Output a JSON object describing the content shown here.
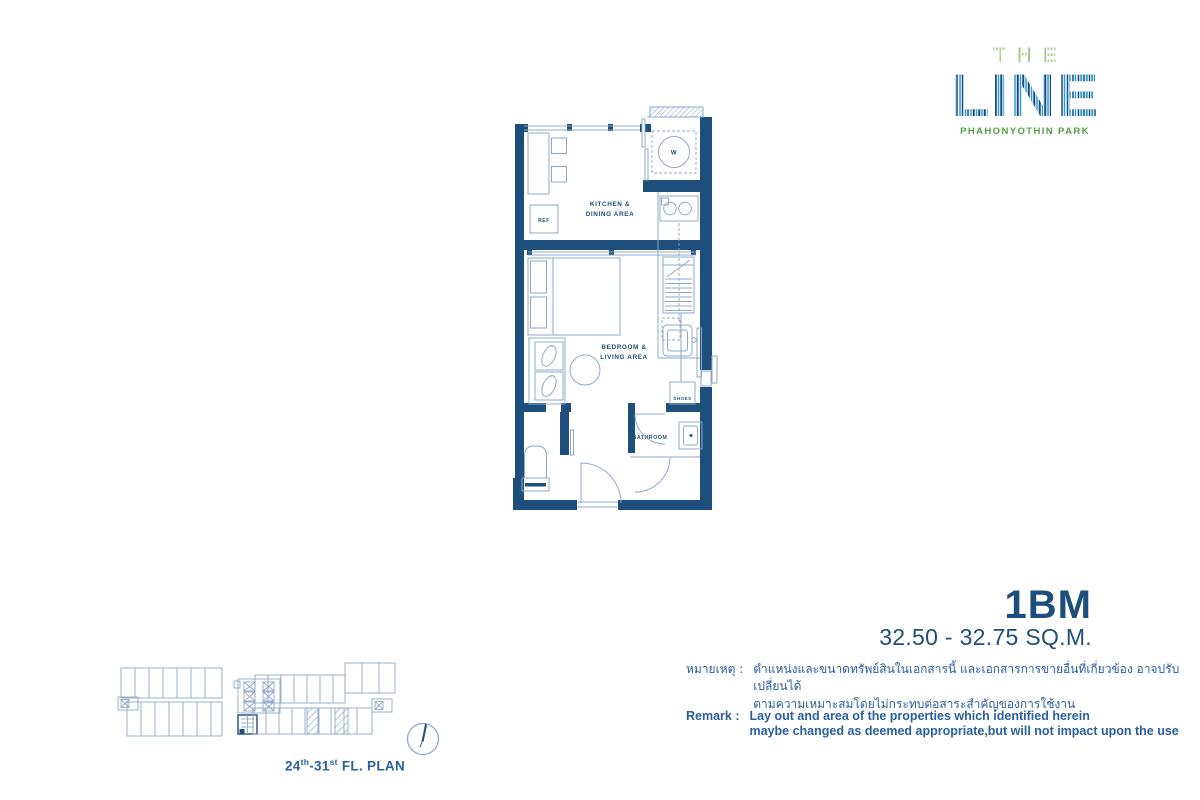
{
  "logo": {
    "the": "THE",
    "line": "LINE",
    "subtitle": "PHAHONYOTHIN PARK",
    "the_green": "#a3cc8b",
    "line_dark_blue": "#17498a",
    "line_light_blue": "#2f9fc4",
    "subtitle_green": "#53a045"
  },
  "unit_plan": {
    "labels": {
      "kitchen1": "KITCHEN &",
      "kitchen2": "DINING AREA",
      "bedroom1": "BEDROOM &",
      "bedroom2": "LIVING AREA",
      "bathroom": "BATHROOM",
      "ref": "REF",
      "shoes": "SHOES",
      "washer": "W"
    },
    "wall_color": "#1d4e7c",
    "thin_line_color": "#8fa9c7"
  },
  "unit_info": {
    "name": "1BM",
    "area": "32.50 - 32.75 SQ.M."
  },
  "remark_th": {
    "label": "หมายเหตุ :",
    "line1": "ตำแหน่งและขนาดทรัพย์สินในเอกสารนี้ และเอกสารการขายอื่นที่เกี่ยวข้อง อาจปรับเปลี่ยนได้",
    "line2": "ตามความเหมาะสมโดยไม่กระทบต่อสาระสำคัญของการใช้งาน"
  },
  "remark_en": {
    "label": "Remark :",
    "line1": "Lay out and area of the properties which identified herein",
    "line2": "maybe changed as deemed appropriate,but will not impact upon the use"
  },
  "key_plan": {
    "caption": [
      "24",
      "th",
      "-31",
      "st",
      " FL. PLAN"
    ]
  }
}
